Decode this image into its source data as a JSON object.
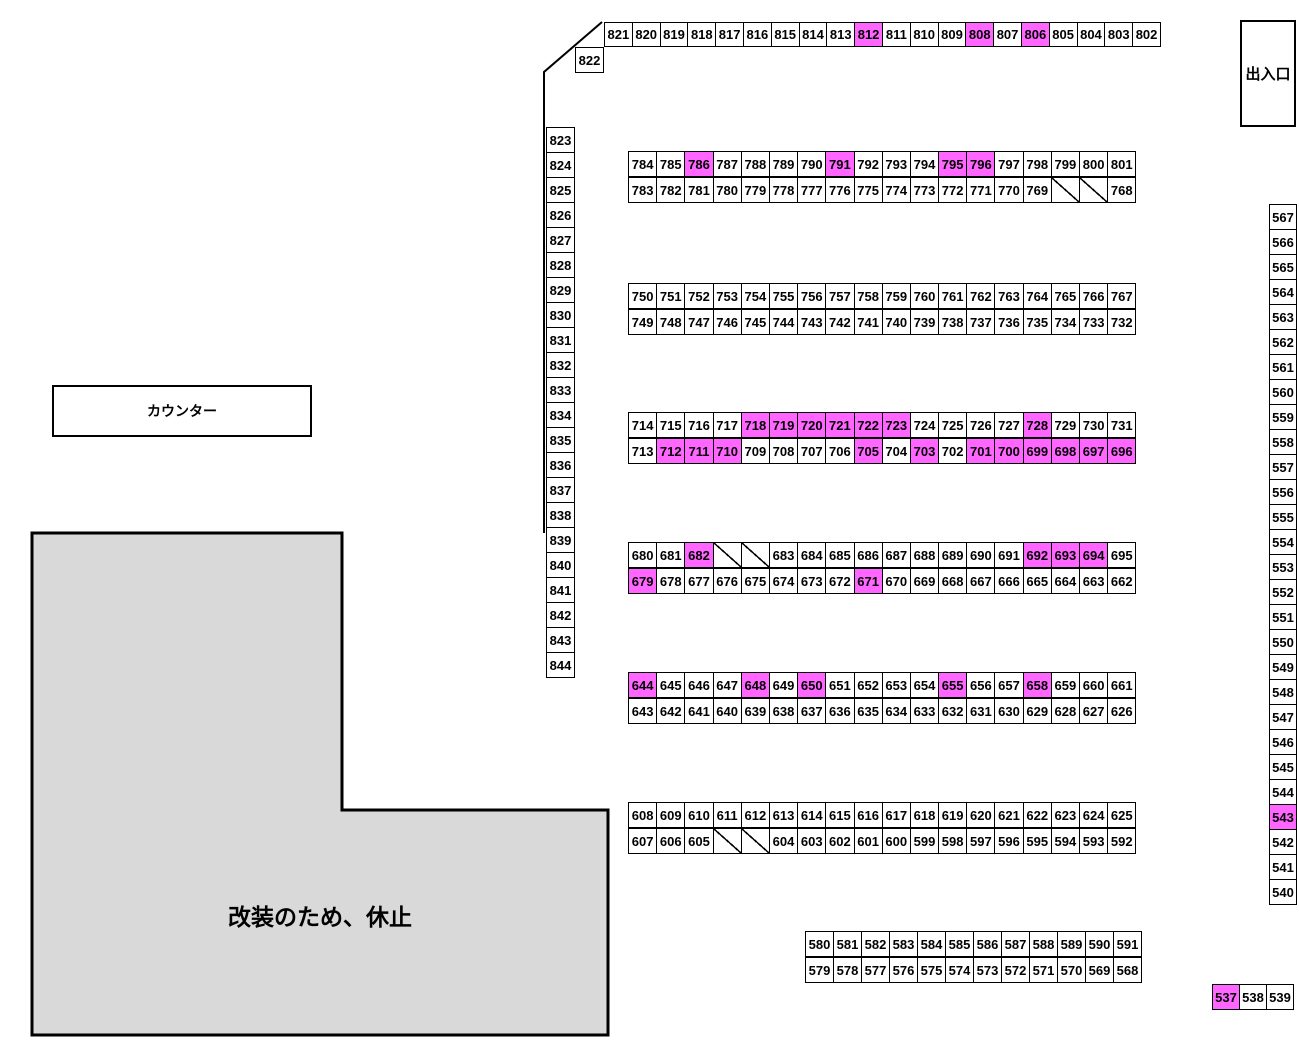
{
  "page": {
    "width": 1299,
    "height": 1046,
    "background": "#ffffff"
  },
  "colors": {
    "highlight": "#ff66ff",
    "cell_background": "#ffffff",
    "border": "#000000",
    "closed_area_fill": "#d9d9d9"
  },
  "labels": {
    "entrance": "出入口",
    "counter": "カウンター",
    "closed": "改装のため、休止"
  },
  "seat_groups": [
    {
      "name": "top-row",
      "x": 604,
      "y": 22,
      "cell_w": 28.8,
      "cell_h": 25,
      "dir": "h",
      "cells": [
        "821",
        "820",
        "819",
        "818",
        "817",
        "816",
        "815",
        "814",
        "813",
        "812",
        "811",
        "810",
        "809",
        "808",
        "807",
        "806",
        "805",
        "804",
        "803",
        "802"
      ],
      "highlight": [
        "812",
        "808",
        "806"
      ]
    },
    {
      "name": "cell-822-group",
      "x": 575,
      "y": 47,
      "cell_w": 29,
      "cell_h": 26,
      "dir": "h",
      "cells": [
        "822"
      ],
      "highlight": []
    },
    {
      "name": "left-column",
      "x": 546,
      "y": 127,
      "cell_w": 29,
      "cell_h": 26,
      "dir": "v",
      "cells": [
        "823",
        "824",
        "825",
        "826",
        "827",
        "828",
        "829",
        "830",
        "831",
        "832",
        "833",
        "834",
        "835",
        "836",
        "837",
        "838",
        "839",
        "840",
        "841",
        "842",
        "843",
        "844"
      ],
      "highlight": []
    },
    {
      "name": "right-column",
      "x": 1269,
      "y": 204,
      "cell_w": 28,
      "cell_h": 26,
      "dir": "v",
      "cells": [
        "567",
        "566",
        "565",
        "564",
        "563",
        "562",
        "561",
        "560",
        "559",
        "558",
        "557",
        "556",
        "555",
        "554",
        "553",
        "552",
        "551",
        "550",
        "549",
        "548",
        "547",
        "546",
        "545",
        "544",
        "543",
        "542",
        "541",
        "540"
      ],
      "highlight": [
        "543"
      ]
    },
    {
      "name": "row-784-801",
      "x": 628,
      "y": 151,
      "cell_w": 29.2,
      "cell_h": 26,
      "dir": "h",
      "cells": [
        "784",
        "785",
        "786",
        "787",
        "788",
        "789",
        "790",
        "791",
        "792",
        "793",
        "794",
        "795",
        "796",
        "797",
        "798",
        "799",
        "800",
        "801"
      ],
      "highlight": [
        "786",
        "791",
        "795",
        "796"
      ]
    },
    {
      "name": "row-783-768",
      "x": 628,
      "y": 177,
      "cell_w": 29.2,
      "cell_h": 26,
      "dir": "h",
      "cells": [
        "783",
        "782",
        "781",
        "780",
        "779",
        "778",
        "777",
        "776",
        "775",
        "774",
        "773",
        "772",
        "771",
        "770",
        "769",
        "/",
        "/",
        "768"
      ],
      "highlight": []
    },
    {
      "name": "row-750-767",
      "x": 628,
      "y": 283,
      "cell_w": 29.2,
      "cell_h": 26,
      "dir": "h",
      "cells": [
        "750",
        "751",
        "752",
        "753",
        "754",
        "755",
        "756",
        "757",
        "758",
        "759",
        "760",
        "761",
        "762",
        "763",
        "764",
        "765",
        "766",
        "767"
      ],
      "highlight": []
    },
    {
      "name": "row-749-732",
      "x": 628,
      "y": 309,
      "cell_w": 29.2,
      "cell_h": 26,
      "dir": "h",
      "cells": [
        "749",
        "748",
        "747",
        "746",
        "745",
        "744",
        "743",
        "742",
        "741",
        "740",
        "739",
        "738",
        "737",
        "736",
        "735",
        "734",
        "733",
        "732"
      ],
      "highlight": []
    },
    {
      "name": "row-714-731",
      "x": 628,
      "y": 412,
      "cell_w": 29.2,
      "cell_h": 26,
      "dir": "h",
      "cells": [
        "714",
        "715",
        "716",
        "717",
        "718",
        "719",
        "720",
        "721",
        "722",
        "723",
        "724",
        "725",
        "726",
        "727",
        "728",
        "729",
        "730",
        "731"
      ],
      "highlight": [
        "718",
        "719",
        "720",
        "721",
        "722",
        "723",
        "728"
      ]
    },
    {
      "name": "row-713-696",
      "x": 628,
      "y": 438,
      "cell_w": 29.2,
      "cell_h": 26,
      "dir": "h",
      "cells": [
        "713",
        "712",
        "711",
        "710",
        "709",
        "708",
        "707",
        "706",
        "705",
        "704",
        "703",
        "702",
        "701",
        "700",
        "699",
        "698",
        "697",
        "696"
      ],
      "highlight": [
        "712",
        "711",
        "710",
        "705",
        "703",
        "701",
        "700",
        "699",
        "698",
        "697",
        "696"
      ]
    },
    {
      "name": "row-680-695",
      "x": 628,
      "y": 542,
      "cell_w": 29.2,
      "cell_h": 26,
      "dir": "h",
      "cells": [
        "680",
        "681",
        "682",
        "/",
        "/",
        "683",
        "684",
        "685",
        "686",
        "687",
        "688",
        "689",
        "690",
        "691",
        "692",
        "693",
        "694",
        "695"
      ],
      "highlight": [
        "682",
        "692",
        "693",
        "694"
      ]
    },
    {
      "name": "row-679-662",
      "x": 628,
      "y": 568,
      "cell_w": 29.2,
      "cell_h": 26,
      "dir": "h",
      "cells": [
        "679",
        "678",
        "677",
        "676",
        "675",
        "674",
        "673",
        "672",
        "671",
        "670",
        "669",
        "668",
        "667",
        "666",
        "665",
        "664",
        "663",
        "662"
      ],
      "highlight": [
        "679",
        "671"
      ]
    },
    {
      "name": "row-644-661",
      "x": 628,
      "y": 672,
      "cell_w": 29.2,
      "cell_h": 26,
      "dir": "h",
      "cells": [
        "644",
        "645",
        "646",
        "647",
        "648",
        "649",
        "650",
        "651",
        "652",
        "653",
        "654",
        "655",
        "656",
        "657",
        "658",
        "659",
        "660",
        "661"
      ],
      "highlight": [
        "644",
        "648",
        "650",
        "655",
        "658"
      ]
    },
    {
      "name": "row-643-626",
      "x": 628,
      "y": 698,
      "cell_w": 29.2,
      "cell_h": 26,
      "dir": "h",
      "cells": [
        "643",
        "642",
        "641",
        "640",
        "639",
        "638",
        "637",
        "636",
        "635",
        "634",
        "633",
        "632",
        "631",
        "630",
        "629",
        "628",
        "627",
        "626"
      ],
      "highlight": []
    },
    {
      "name": "row-608-625",
      "x": 628,
      "y": 802,
      "cell_w": 29.2,
      "cell_h": 26,
      "dir": "h",
      "cells": [
        "608",
        "609",
        "610",
        "611",
        "612",
        "613",
        "614",
        "615",
        "616",
        "617",
        "618",
        "619",
        "620",
        "621",
        "622",
        "623",
        "624",
        "625"
      ],
      "highlight": []
    },
    {
      "name": "row-607-592",
      "x": 628,
      "y": 828,
      "cell_w": 29.2,
      "cell_h": 26,
      "dir": "h",
      "cells": [
        "607",
        "606",
        "605",
        "/",
        "/",
        "604",
        "603",
        "602",
        "601",
        "600",
        "599",
        "598",
        "597",
        "596",
        "595",
        "594",
        "593",
        "592"
      ],
      "highlight": []
    },
    {
      "name": "row-580-591",
      "x": 805,
      "y": 931,
      "cell_w": 29,
      "cell_h": 26,
      "dir": "h",
      "cells": [
        "580",
        "581",
        "582",
        "583",
        "584",
        "585",
        "586",
        "587",
        "588",
        "589",
        "590",
        "591"
      ],
      "highlight": []
    },
    {
      "name": "row-579-568",
      "x": 805,
      "y": 957,
      "cell_w": 29,
      "cell_h": 26,
      "dir": "h",
      "cells": [
        "579",
        "578",
        "577",
        "576",
        "575",
        "574",
        "573",
        "572",
        "571",
        "570",
        "569",
        "568"
      ],
      "highlight": []
    },
    {
      "name": "row-537-539",
      "x": 1212,
      "y": 984,
      "cell_w": 28,
      "cell_h": 26,
      "dir": "h",
      "cells": [
        "537",
        "538",
        "539"
      ],
      "highlight": [
        "537"
      ]
    }
  ]
}
